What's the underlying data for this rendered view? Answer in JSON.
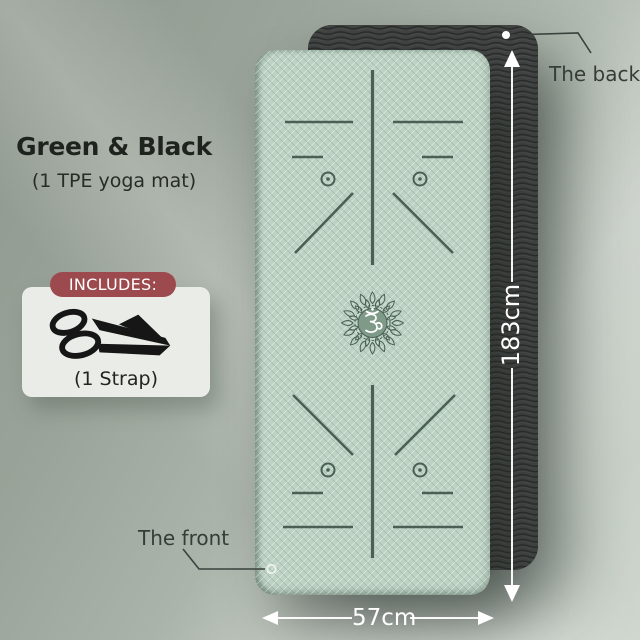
{
  "product": {
    "title": "Green & Black",
    "subtitle": "(1 TPE yoga mat)"
  },
  "includes": {
    "badge_label": "INCLUDES:",
    "item_label": "(1 Strap)",
    "icon": "yoga-strap-icon"
  },
  "annotations": {
    "back_label": "The back",
    "front_label": "The front",
    "length_label": "183cm",
    "width_label": "57cm"
  },
  "icons": {
    "center_symbol": "om-symbol",
    "center_ornament": "mandala",
    "front_marker": "ring-marker",
    "back_marker": "dot-marker"
  },
  "colors": {
    "front_mat": "#bed3c5",
    "back_mat": "#3f4241",
    "alignment_lines": "#4a6054",
    "badge": "#9d4a4e",
    "card": "#e9ece7",
    "dimension_text": "#ffffff",
    "label_text": "#363c38",
    "background_dark": "#8f988e",
    "background_light": "#ced6cd"
  }
}
